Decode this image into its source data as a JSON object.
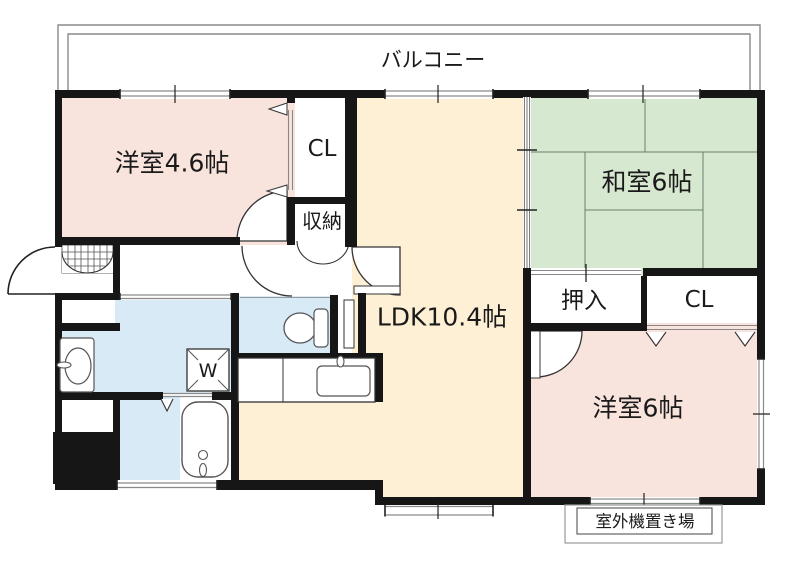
{
  "title": "apartment-floor-plan",
  "labels": {
    "balcony": "バルコニー",
    "west_room_small": "洋室4.6帖",
    "closet_upper": "CL",
    "storage": "収納",
    "japanese_room": "和室6帖",
    "ldk": "LDK10.4帖",
    "oshiire": "押入",
    "closet_right": "CL",
    "west_room_large": "洋室6帖",
    "outdoor_unit": "室外機置き場",
    "washer": "W"
  },
  "colors": {
    "wall": "#161616",
    "western_room": "#f9e4dd",
    "japanese_room": "#d7e8d1",
    "ldk": "#fdf0d5",
    "wet_area": "#d8eaf6",
    "window_line": "#8a8a8a",
    "thin_line": "#555555",
    "tatami_line": "#6b7f6b",
    "background": "#ffffff"
  }
}
